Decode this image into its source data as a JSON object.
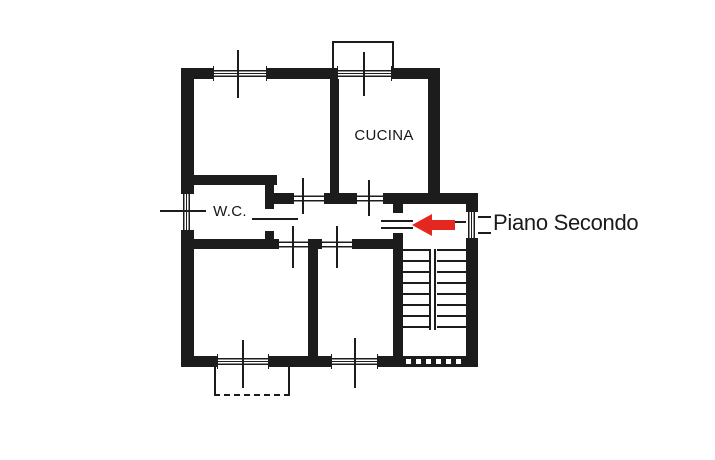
{
  "plan": {
    "room_labels": {
      "kitchen": "CUCINA",
      "wc": "W.C."
    },
    "annotation": {
      "floor_label": "Piano Secondo"
    },
    "colors": {
      "ink": "#1c1c1c",
      "arrow": "#e4271f",
      "paper": "#ffffff"
    },
    "icons": {
      "arrow": "left-arrow-icon"
    },
    "stairs": {
      "flights": 2,
      "visible_steps_per_flight": 8
    }
  }
}
